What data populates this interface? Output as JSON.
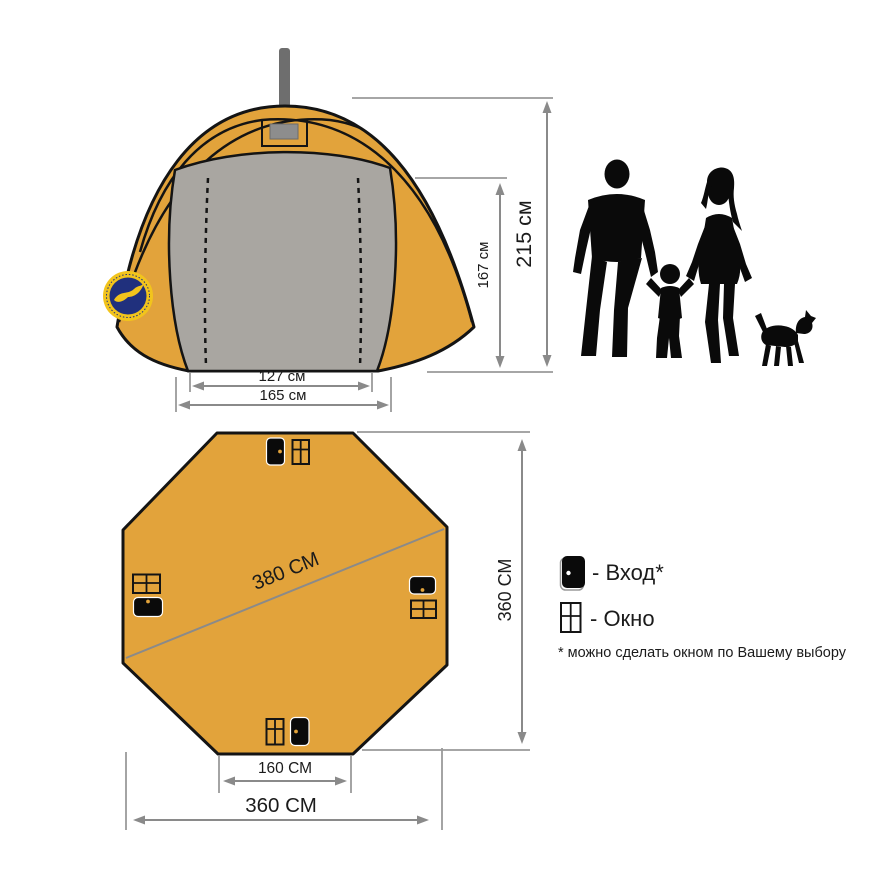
{
  "front_view": {
    "dim_total_height": "215 см",
    "dim_door_height": "167 см",
    "dim_inner_width": "127 см",
    "dim_outer_width": "165 см"
  },
  "plan_view": {
    "dim_diagonal": "380 СМ",
    "dim_side_height": "360 СМ",
    "dim_bottom_edge": "160 СМ",
    "dim_total_width": "360 СМ"
  },
  "legend": {
    "entrance": "- Вход*",
    "window": "- Окно",
    "footnote": "* можно сделать окном по Вашему выбору"
  },
  "icons": {
    "door": "door-icon",
    "window": "window-icon",
    "logo": "brand-badge-icon",
    "family": "family-silhouette"
  },
  "colors": {
    "tent": "#E2A33B",
    "panel": "#A9A6A1",
    "outline": "#141414",
    "dimension": "#8A8A8A",
    "text": "#1B1B1B",
    "logo_navy": "#20307D",
    "logo_yellow": "#F2C41C",
    "chimney": "#6E6E6E",
    "silhouette": "#0A0A0A"
  }
}
